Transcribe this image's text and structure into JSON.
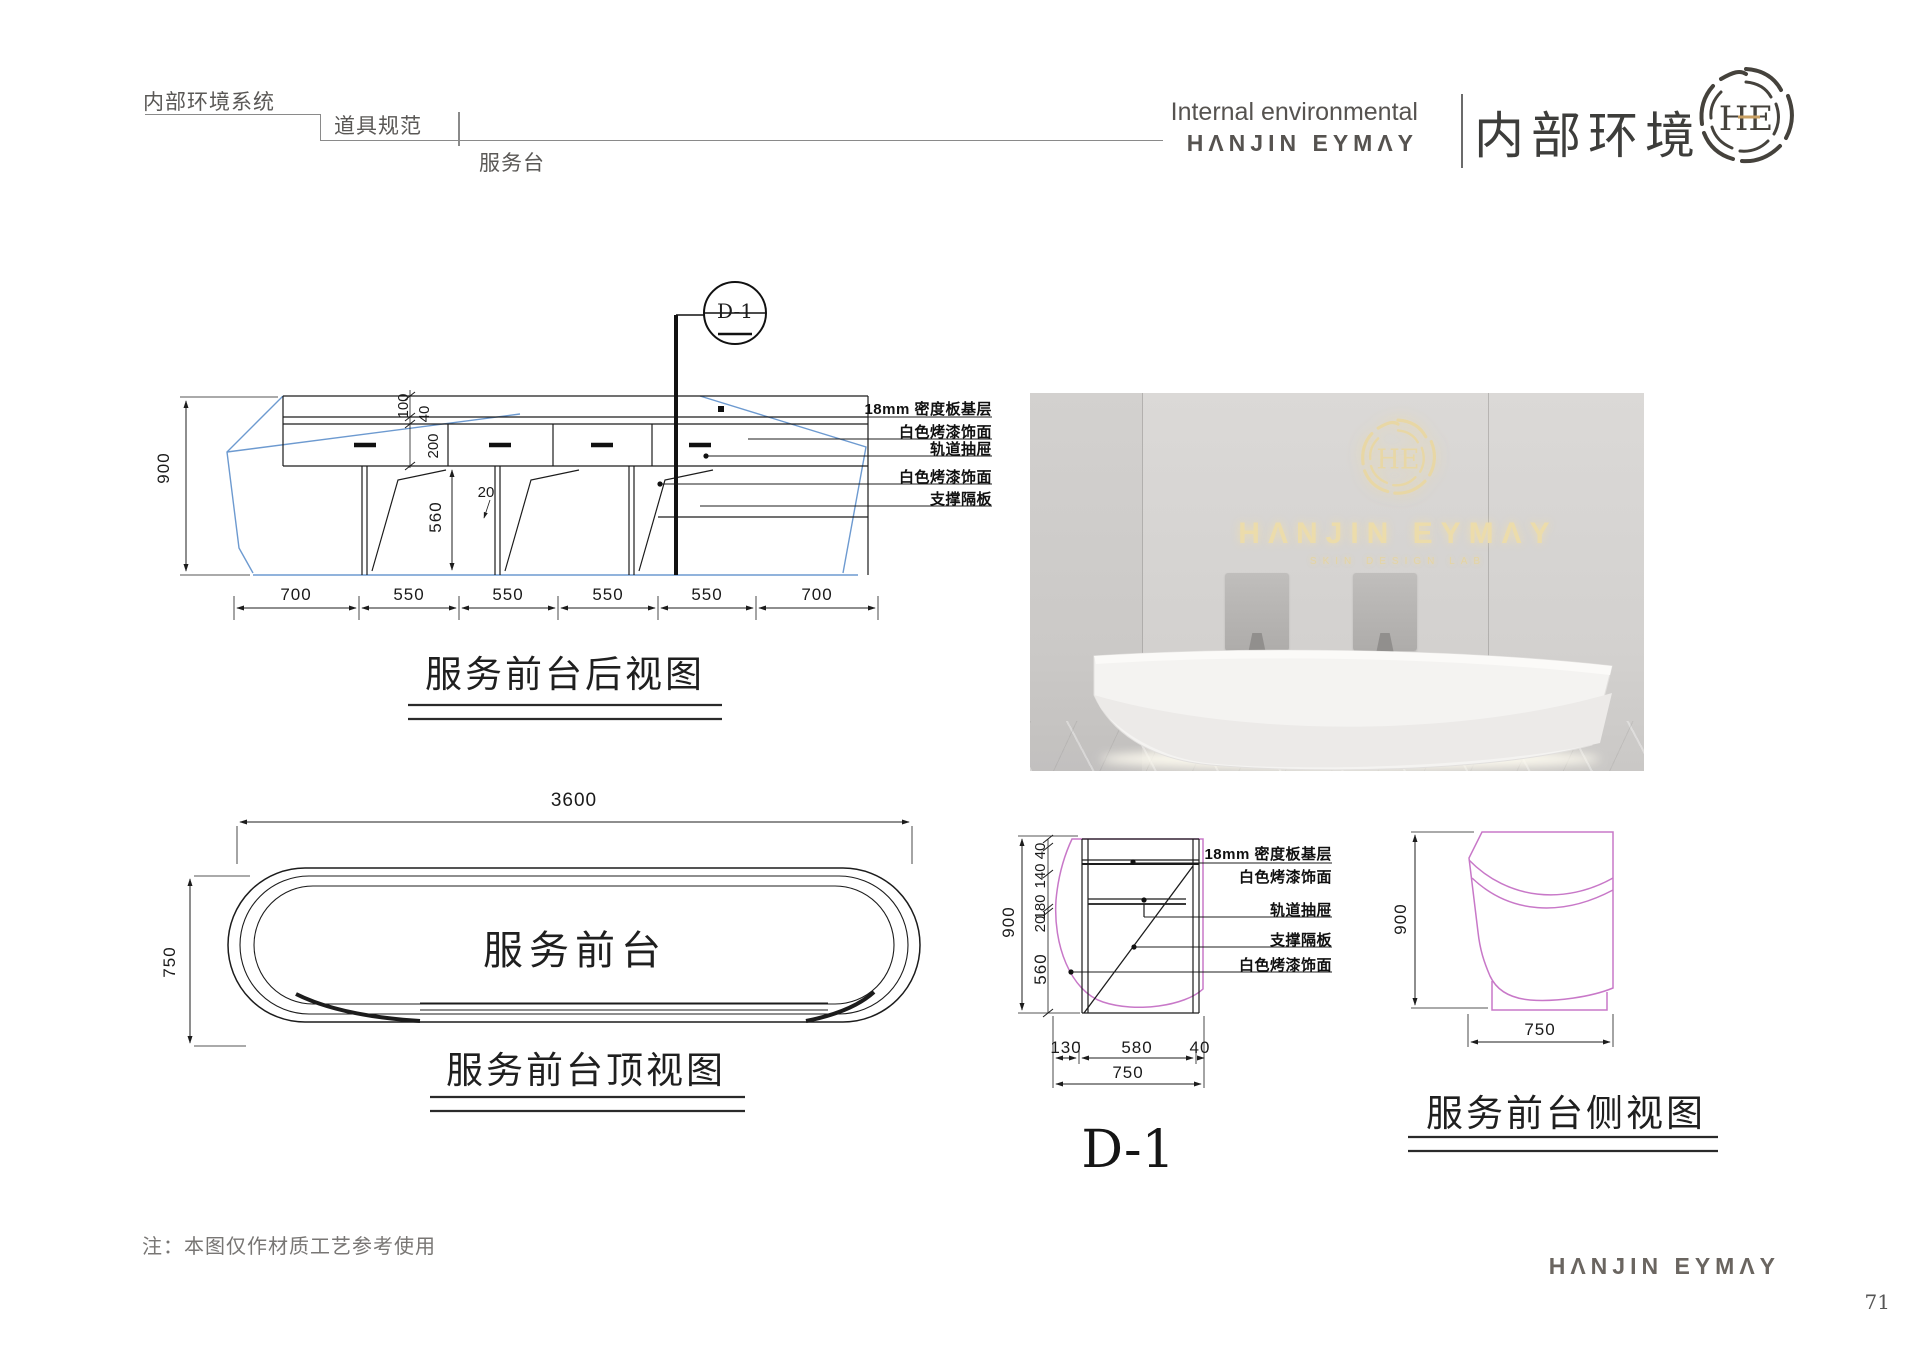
{
  "header": {
    "breadcrumb": {
      "level1": "内部环境系统",
      "level2": "道具规范",
      "level3": "服务台"
    },
    "right": {
      "line1": "Internal environmental",
      "line2": "HΛNJIN EYMΛY",
      "cn": "内部环境",
      "monogram": "HE"
    }
  },
  "rear_view": {
    "callout": "D-1",
    "title": "服务前台后视图",
    "dim_height": "900",
    "dim_top": "100",
    "dim_gap": "40",
    "dim_drawer": "200",
    "dim_lower": "560",
    "dim_panel": "20",
    "dims_bottom": [
      "700",
      "550",
      "550",
      "550",
      "550",
      "700"
    ],
    "annotations": [
      "18mm 密度板基层",
      "白色烤漆饰面",
      "轨道抽屉",
      "白色烤漆饰面",
      "支撑隔板"
    ]
  },
  "top_view": {
    "title": "服务前台顶视图",
    "label": "服务前台",
    "dim_width": "3600",
    "dim_depth": "750"
  },
  "detail": {
    "title": "D-1",
    "dim_height": "900",
    "dims_left": [
      "40",
      "140",
      "180",
      "20",
      "560"
    ],
    "dims_bottom": [
      "130",
      "580",
      "40"
    ],
    "dim_total": "750",
    "annotations": [
      "18mm 密度板基层",
      "白色烤漆饰面",
      "轨道抽屉",
      "支撑隔板",
      "白色烤漆饰面"
    ]
  },
  "side_view": {
    "title": "服务前台侧视图",
    "dim_height": "900",
    "dim_width": "750"
  },
  "photo": {
    "monogram": "HE",
    "brand": "HΛNJIN EYMΛY",
    "subtitle": "SKIN DESIGN LAB"
  },
  "footer": {
    "note": "注：本图仅作材质工艺参考使用",
    "brand": "HΛNJIN EYMΛY",
    "page": "71"
  },
  "colors": {
    "accent_gold": "#c9a063",
    "blueprint_blue": "#6d9ad0",
    "detail_magenta": "#c878c8"
  }
}
